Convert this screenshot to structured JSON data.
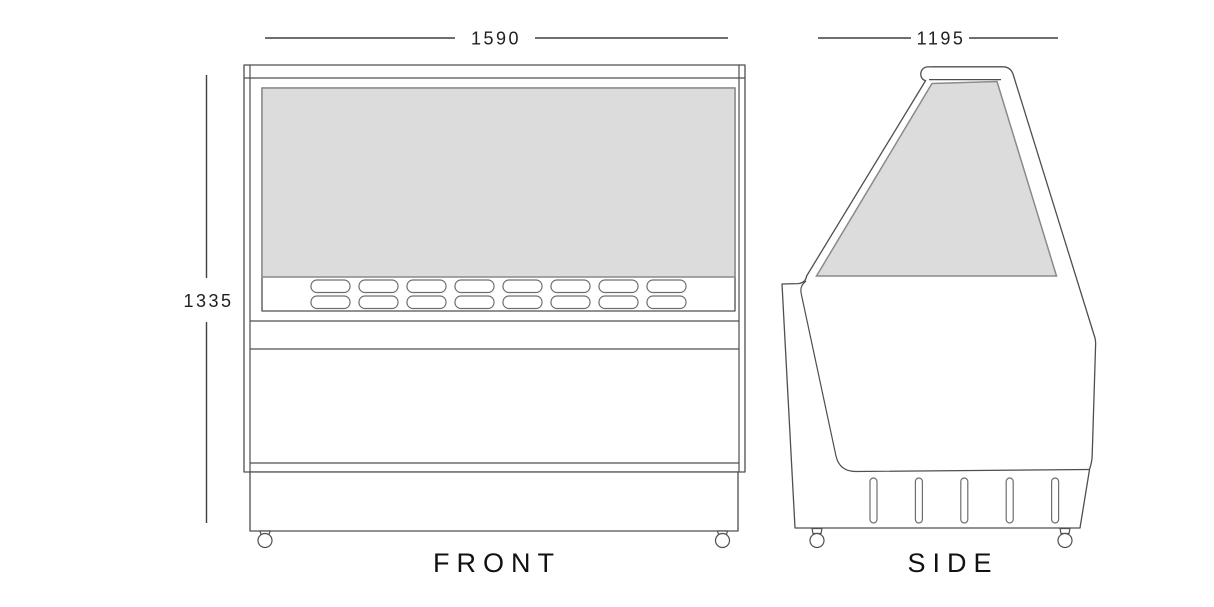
{
  "drawing": {
    "type": "technical-drawing",
    "subject": "refrigerated serve-over display counter, front and side elevations",
    "views": {
      "front": {
        "label": "FRONT",
        "width_dim": "1590",
        "height_dim": "1335",
        "vent_slots": {
          "rows": 2,
          "per_row": 8
        },
        "casters": 2
      },
      "side": {
        "label": "SIDE",
        "depth_dim": "1195",
        "vent_slots": {
          "rows": 1,
          "per_row": 5
        },
        "casters": 2
      }
    },
    "colors": {
      "glass_fill": "#dcdcdc",
      "line": "#4f4f4f",
      "text": "#1f1f1f",
      "background": "#ffffff"
    }
  }
}
